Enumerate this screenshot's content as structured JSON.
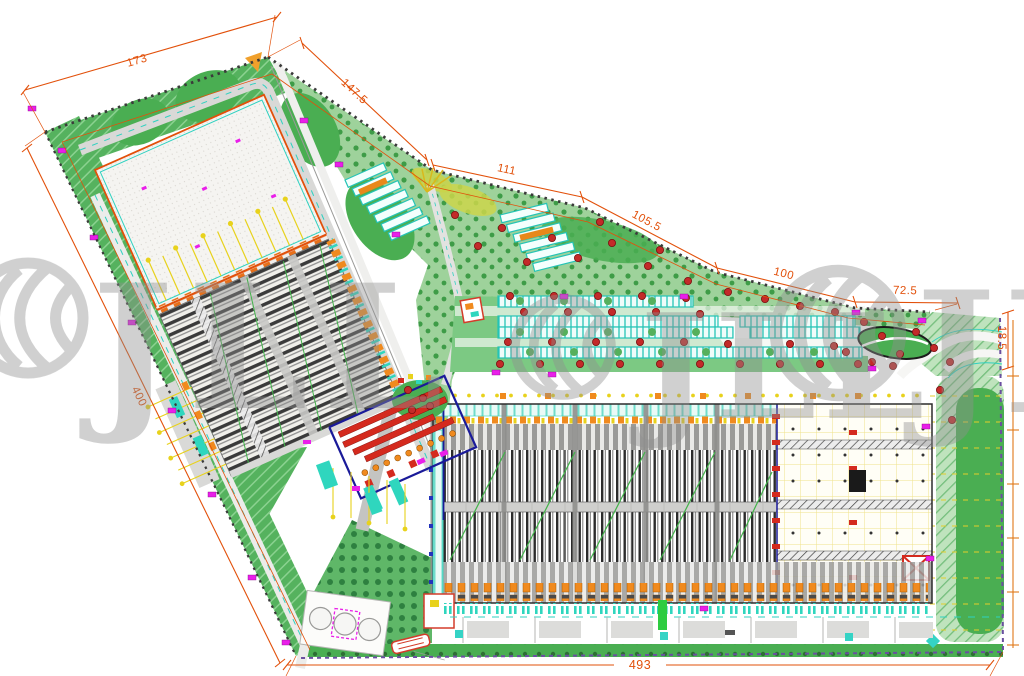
{
  "plan": {
    "type": "industrial-logistics-park-site-plan",
    "dimensions": {
      "top_1": "173",
      "top_2": "147.5",
      "top_3": "111",
      "top_4": "105.5",
      "top_5": "100",
      "top_6": "72.5",
      "right_width": "18.5",
      "left_side": "400",
      "bottom_side": "493"
    },
    "watermark": {
      "brand": "JLL",
      "repeat_1": "JLL",
      "repeat_2": "JLL",
      "repeat_3": "JLL"
    },
    "colors": {
      "dimension_line": "#e2500a",
      "landscape_green": "#4aae52",
      "grove_green": "#9ed29b",
      "parking_teal": "#27c6b8",
      "racking_dark": "#2b2b2b",
      "dock_orange": "#f08a1e",
      "marker_magenta": "#e91fe9",
      "tree_red": "#c32a29",
      "accent_navy": "#1a1a99",
      "watermark_gray": "#909090"
    }
  }
}
